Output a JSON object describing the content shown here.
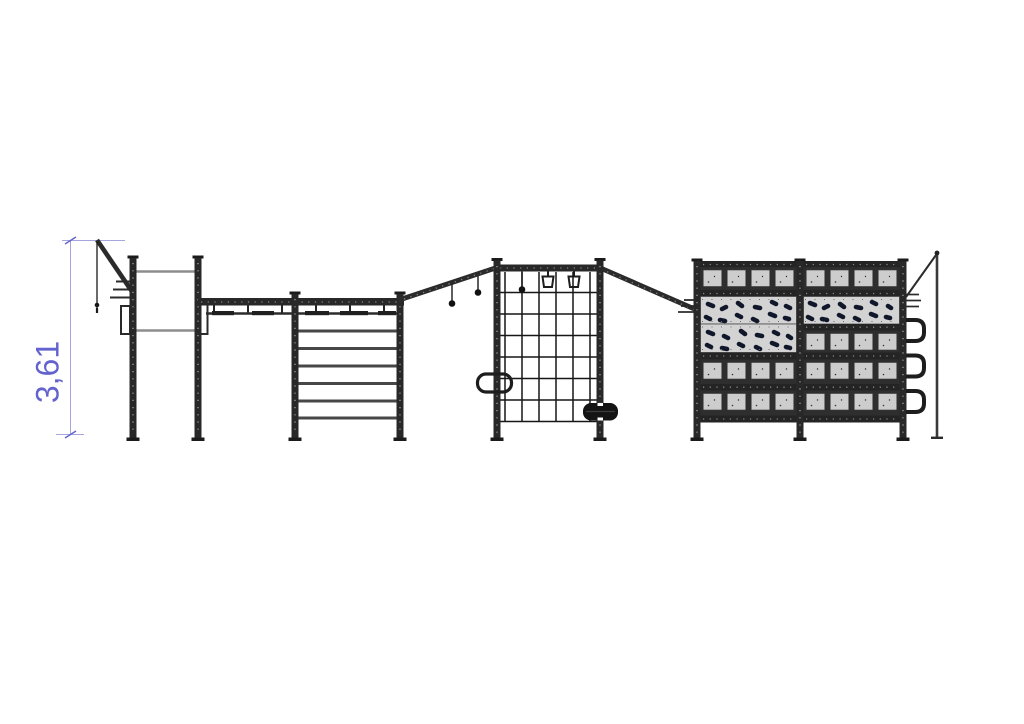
{
  "drawing": {
    "dimension": {
      "label": "3,61"
    },
    "colors": {
      "background": "#ffffff",
      "frame_dark": "#282828",
      "bar_light": "#8d8d8d",
      "panel_gray": "#d3d3d3",
      "holds_navy": "#10172a",
      "dimension_blue": "#6363cf",
      "dimension_line": "#a6a6de"
    },
    "components": [
      "height-dimension",
      "climbing-rope-arm",
      "pull-up-station",
      "monkey-bar-beam",
      "wall-bars-ladder",
      "hanging-ball-grips",
      "gym-rings",
      "cargo-net-frame",
      "loop-handle",
      "tire-step",
      "climbing-wall",
      "staple-rungs",
      "rope-pole"
    ]
  }
}
